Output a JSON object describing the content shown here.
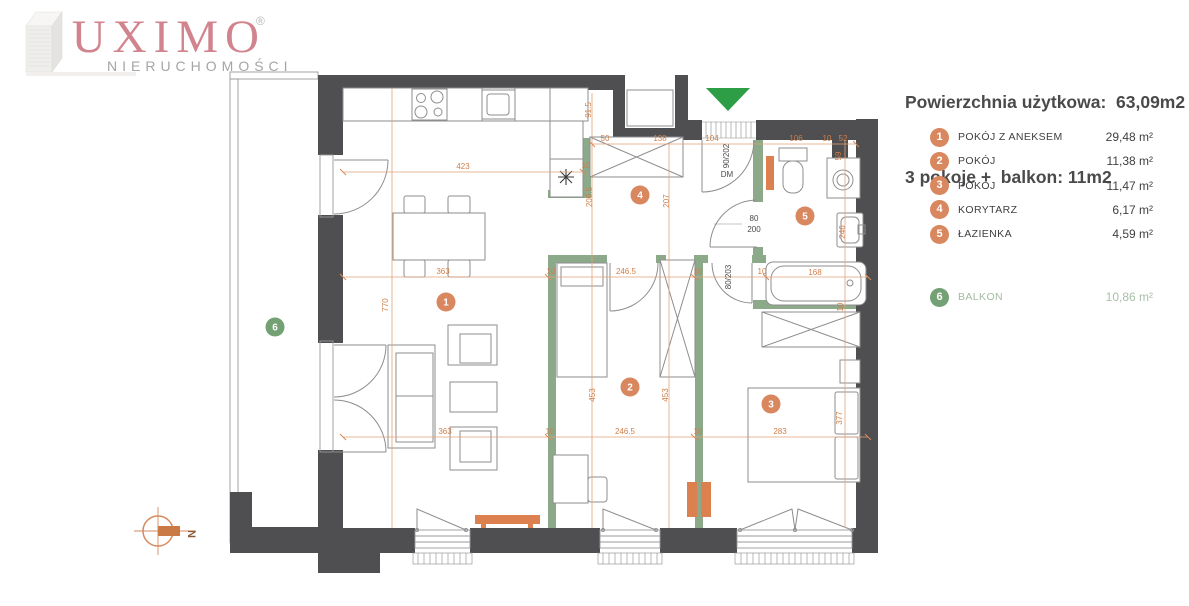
{
  "brand": {
    "name": "LUXIMO",
    "registered": "®",
    "subtitle": "NIERUCHOMOŚCI"
  },
  "header": {
    "line1": "Powierzchnia użytkowa:  63,09m2",
    "line2": "3 pokoje +  balkon: 11m2"
  },
  "legend": {
    "rows": [
      {
        "num": "1",
        "label": "POKÓJ Z ANEKSEM",
        "value": "29,48 m²",
        "type": "room"
      },
      {
        "num": "2",
        "label": "POKÓJ",
        "value": "11,38 m²",
        "type": "room"
      },
      {
        "num": "3",
        "label": "POKÓJ",
        "value": "11,47 m²",
        "type": "room"
      },
      {
        "num": "4",
        "label": "KORYTARZ",
        "value": "6,17 m²",
        "type": "room"
      },
      {
        "num": "5",
        "label": "ŁAZIENKA",
        "value": "4,59 m²",
        "type": "room"
      },
      {
        "num": "6",
        "label": "BALKON",
        "value": "10,86 m²",
        "type": "balcony"
      }
    ]
  },
  "plan": {
    "room_badges": [
      {
        "num": "1",
        "x": 446,
        "y": 302,
        "kind": "room"
      },
      {
        "num": "2",
        "x": 630,
        "y": 387,
        "kind": "room"
      },
      {
        "num": "3",
        "x": 771,
        "y": 404,
        "kind": "room"
      },
      {
        "num": "4",
        "x": 640,
        "y": 195,
        "kind": "room"
      },
      {
        "num": "5",
        "x": 805,
        "y": 216,
        "kind": "room"
      },
      {
        "num": "6",
        "x": 275,
        "y": 327,
        "kind": "balcony"
      }
    ],
    "dim_labels": [
      {
        "t": "423",
        "x": 463,
        "y": 169,
        "r": 0,
        "c": "dim"
      },
      {
        "t": "10",
        "x": 586,
        "y": 168,
        "r": 0,
        "c": "dim"
      },
      {
        "t": "50",
        "x": 605,
        "y": 141,
        "r": 0,
        "c": "dim"
      },
      {
        "t": "138",
        "x": 660,
        "y": 141,
        "r": 0,
        "c": "dim"
      },
      {
        "t": "104",
        "x": 712,
        "y": 141,
        "r": 0,
        "c": "dim"
      },
      {
        "t": "106",
        "x": 796,
        "y": 141,
        "r": 0,
        "c": "dim"
      },
      {
        "t": "10",
        "x": 827,
        "y": 141,
        "r": 0,
        "c": "dim"
      },
      {
        "t": "52",
        "x": 843,
        "y": 141,
        "r": 0,
        "c": "dim"
      },
      {
        "t": "59",
        "x": 841,
        "y": 156,
        "r": -90,
        "c": "dim"
      },
      {
        "t": "91.5",
        "x": 591,
        "y": 110,
        "r": -90,
        "c": "dim"
      },
      {
        "t": "206.5",
        "x": 592,
        "y": 197,
        "r": -90,
        "c": "dim"
      },
      {
        "t": "207",
        "x": 669,
        "y": 201,
        "r": -90,
        "c": "dim"
      },
      {
        "t": "770",
        "x": 388,
        "y": 305,
        "r": -90,
        "c": "dim"
      },
      {
        "t": "363",
        "x": 443,
        "y": 274,
        "r": 0,
        "c": "dim"
      },
      {
        "t": "10",
        "x": 551,
        "y": 274,
        "r": 0,
        "c": "dim"
      },
      {
        "t": "246.5",
        "x": 626,
        "y": 274,
        "r": 0,
        "c": "dim"
      },
      {
        "t": "10",
        "x": 698,
        "y": 274,
        "r": 0,
        "c": "dim"
      },
      {
        "t": "10",
        "x": 762,
        "y": 274,
        "r": 0,
        "c": "dim"
      },
      {
        "t": "168",
        "x": 815,
        "y": 275,
        "r": 0,
        "c": "dim"
      },
      {
        "t": "246",
        "x": 845,
        "y": 232,
        "r": -90,
        "c": "dim"
      },
      {
        "t": "10",
        "x": 843,
        "y": 307,
        "r": -90,
        "c": "dim"
      },
      {
        "t": "453",
        "x": 595,
        "y": 395,
        "r": -90,
        "c": "dim"
      },
      {
        "t": "453",
        "x": 668,
        "y": 395,
        "r": -90,
        "c": "dim"
      },
      {
        "t": "377",
        "x": 842,
        "y": 418,
        "r": -90,
        "c": "dim"
      },
      {
        "t": "363",
        "x": 445,
        "y": 434,
        "r": 0,
        "c": "dim"
      },
      {
        "t": "10",
        "x": 550,
        "y": 434,
        "r": 0,
        "c": "dim"
      },
      {
        "t": "246.5",
        "x": 625,
        "y": 434,
        "r": 0,
        "c": "dim"
      },
      {
        "t": "10",
        "x": 698,
        "y": 434,
        "r": 0,
        "c": "dim"
      },
      {
        "t": "283",
        "x": 780,
        "y": 434,
        "r": 0,
        "c": "dim"
      },
      {
        "t": "90/202",
        "x": 729,
        "y": 156,
        "r": -90,
        "c": "door"
      },
      {
        "t": "DM",
        "x": 727,
        "y": 177,
        "r": 0,
        "c": "door"
      },
      {
        "t": "80",
        "x": 754,
        "y": 221,
        "r": 0,
        "c": "door"
      },
      {
        "t": "200",
        "x": 754,
        "y": 232,
        "r": 0,
        "c": "door"
      },
      {
        "t": "80/203",
        "x": 731,
        "y": 277,
        "r": -90,
        "c": "door"
      },
      {
        "t": "N",
        "x": 188,
        "y": 534,
        "r": 90,
        "c": "compass"
      }
    ]
  },
  "colors": {
    "wall": "#4f4f51",
    "green_wall": "#8caa8a",
    "dimension": "#cf7f48",
    "badge_room": "#d8875f",
    "badge_balcony": "#74a173",
    "entry_arrow": "#2d9e45",
    "radiator": "#dd8050",
    "brand": "#d2848e"
  }
}
